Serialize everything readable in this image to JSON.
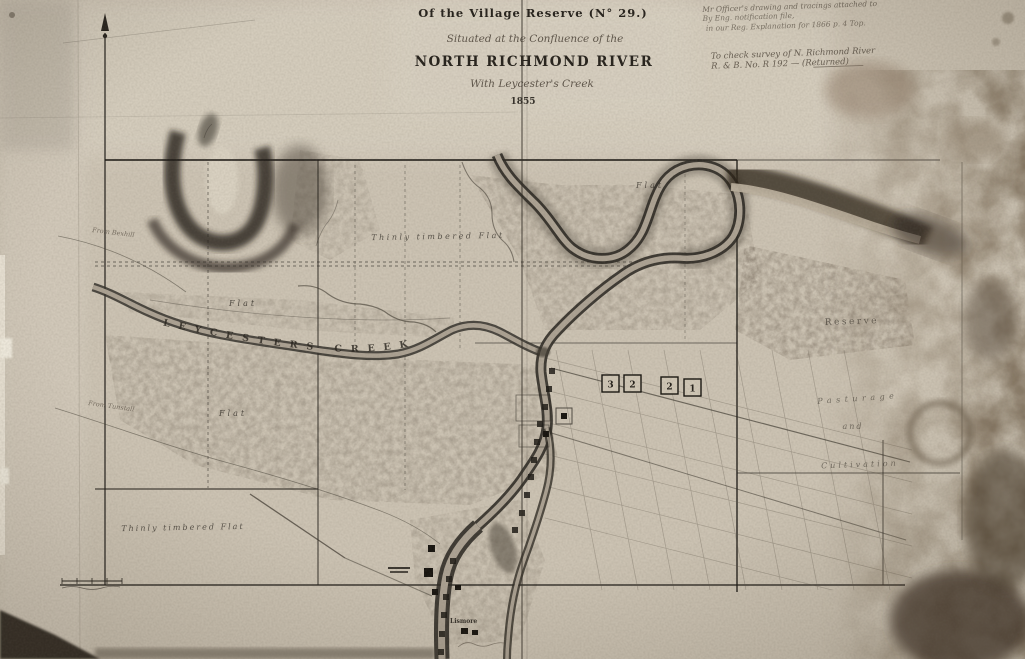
{
  "title_block": {
    "line1": "Of the Village Reserve (N° 29.)",
    "line2": "Situated at the Confluence of the",
    "line3": "NORTH RICHMOND RIVER",
    "line4": "With Leycester's Creek",
    "date": "1855"
  },
  "surveyor_notes": {
    "note1_line1": "Mr Officer's drawing and tracings attached to",
    "note1_line2": "By Eng. notification file,",
    "note1_line3": "in our Reg. Explanation for 1866 p. 4 Top.",
    "note2_line1": "To check survey of N. Richmond River",
    "note2_line2": "R. & B. No. R 192 — (Returned)"
  },
  "map_labels": {
    "creek_name": "LEYCESTERS CREEK",
    "flat_upper_left": "Flat",
    "flat_lower_left": "Flat",
    "flat_top_right": "Flat",
    "thinly_timbered_flat_north": "Thinly timbered Flat",
    "thinly_timbered_flat_south": "Thinly timbered Flat",
    "reserve": "Reserve",
    "pasturage": "Pasturage",
    "conj_and": "and",
    "cultivation": "Cultivation",
    "road_from_bexhill": "From Bexhill",
    "road_from_tunstall": "From Tunstall",
    "village_name": "Lismore"
  },
  "section_squares": {
    "numbers": [
      "3",
      "2",
      "2",
      "1"
    ]
  },
  "colors": {
    "paper": "#ccc3b3",
    "ink": "#26221c",
    "stain": "#6f5e49",
    "water": "#aca293"
  }
}
